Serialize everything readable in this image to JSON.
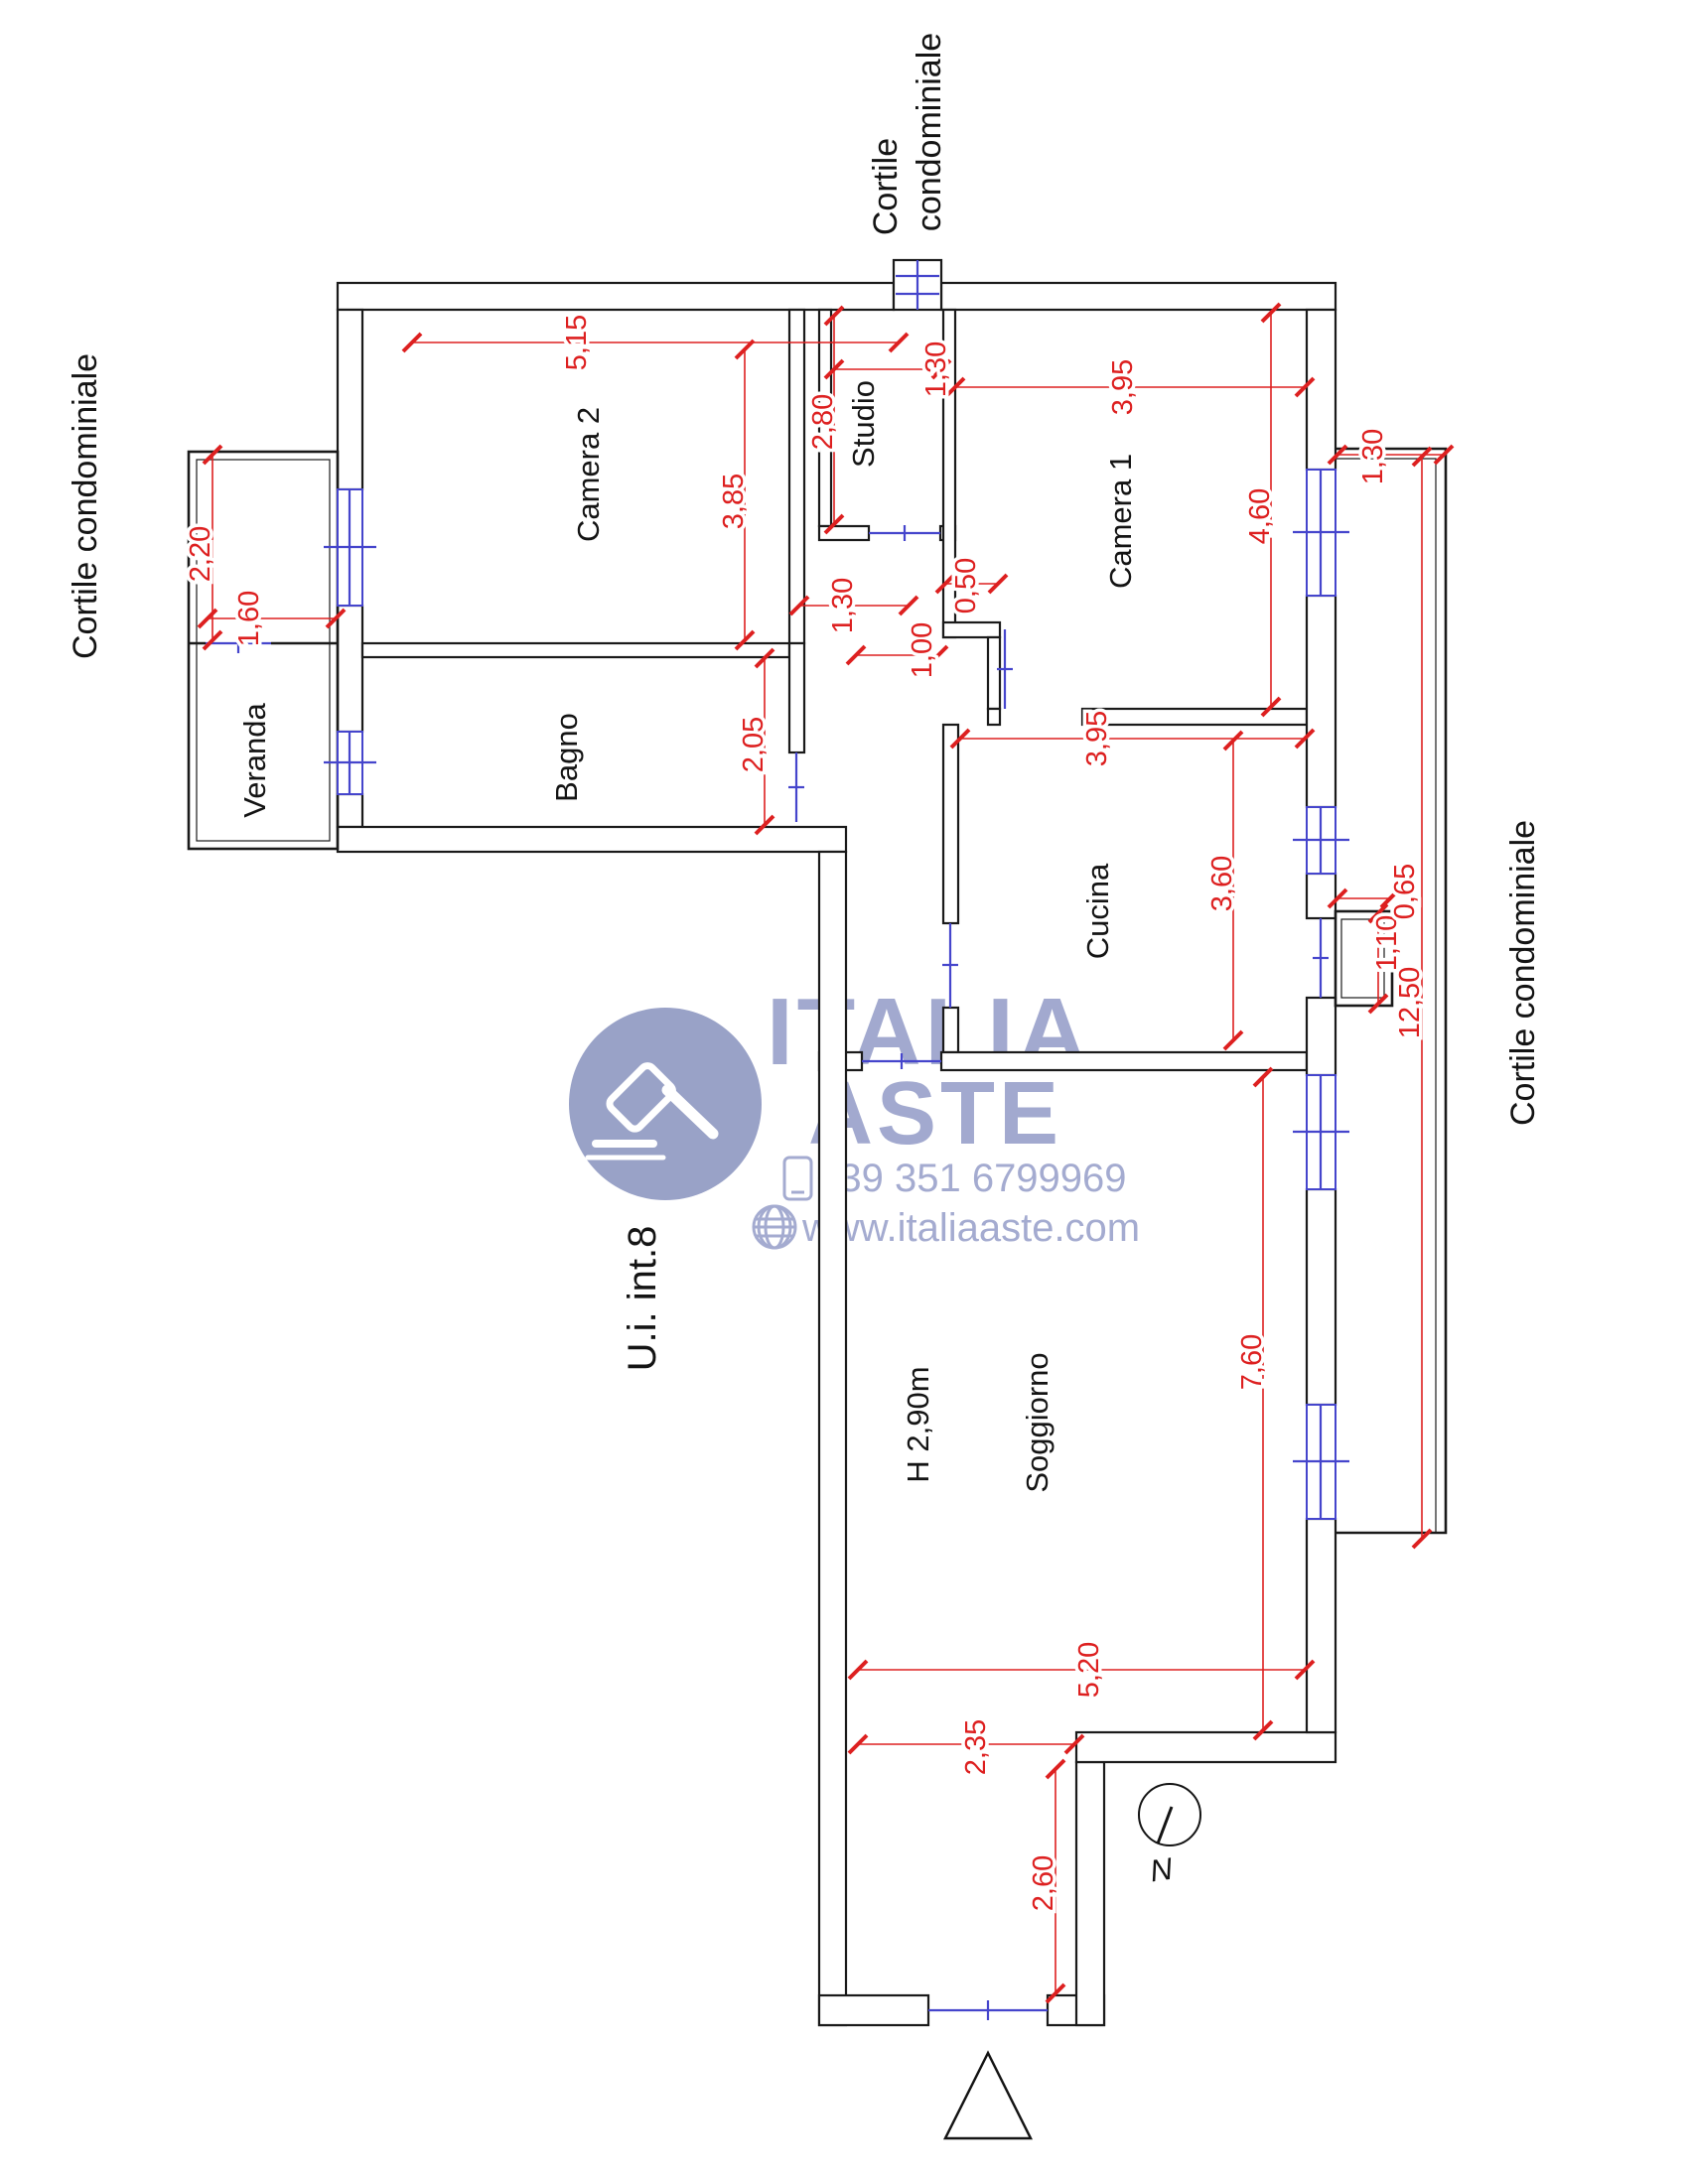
{
  "plan": {
    "courtyard_label_top": {
      "line1": "Cortile",
      "line2": "condominiale"
    },
    "courtyard_label_left": "Cortile condominiale",
    "courtyard_label_right": "Cortile condominiale",
    "unit_label": "U.i.  int.8",
    "north_label": "N",
    "rooms": {
      "camera2": "Camera 2",
      "studio": "Studio",
      "camera1": "Camera 1",
      "bagno": "Bagno",
      "veranda": "Veranda",
      "cucina": "Cucina",
      "soggiorno": "Soggiorno",
      "ceiling_height": "H 2,90m"
    },
    "dimensions": {
      "camera2_width": "5,15",
      "camera2_depth": "3,85",
      "studio_depth": "2,80",
      "studio_width": "1,30",
      "camera1_width": "3,95",
      "camera1_depth": "4,60",
      "balcony_top_width": "1,30",
      "veranda_upper_depth": "2,20",
      "veranda_door_width": "1,60",
      "bagno_depth": "2,05",
      "hall_width": "1,30",
      "wall_jog": "0,50",
      "camera1_door_width": "1,00",
      "cucina_width": "3,95",
      "cucina_depth": "3,60",
      "balcony_step_length": "1,10",
      "balcony_step_depth": "0,65",
      "balcony_length": "12,50",
      "soggiorno_depth": "7,60",
      "soggiorno_width": "5,20",
      "entry_offset": "2,35",
      "entry_depth": "2,60"
    }
  },
  "watermark": {
    "brand_top": "ITALIA",
    "brand_bottom": "ASTE",
    "phone": "+39 351 6799969",
    "website": "www.italiaaste.com"
  },
  "colors": {
    "walls": "#1a1a1a",
    "dimensions": "#dd2020",
    "openings": "#4545cc",
    "watermark": "#98a0ca"
  }
}
